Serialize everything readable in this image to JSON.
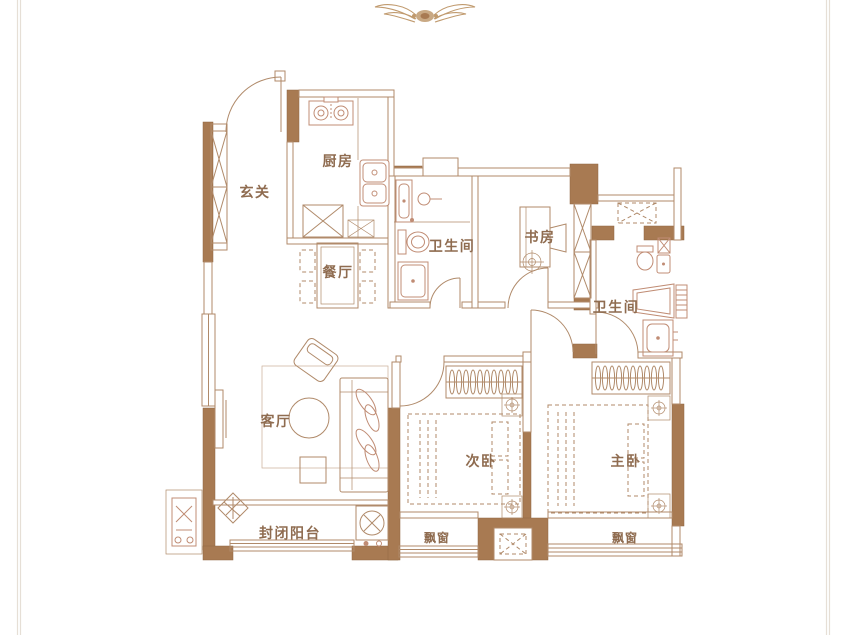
{
  "title": "apartment-floor-plan",
  "ornament": "winged-emblem",
  "rooms": {
    "entry": {
      "label": "玄关"
    },
    "kitchen": {
      "label": "厨房"
    },
    "bath1": {
      "label": "卫生间"
    },
    "study": {
      "label": "书房"
    },
    "dining": {
      "label": "餐厅"
    },
    "living": {
      "label": "客厅"
    },
    "bedroom2": {
      "label": "次卧"
    },
    "master": {
      "label": "主卧"
    },
    "bath2": {
      "label": "卫生间"
    },
    "balcony": {
      "label": "封闭阳台"
    },
    "bay_left": {
      "label": "飘窗"
    },
    "bay_right": {
      "label": "飘窗"
    }
  },
  "colors": {
    "wall": "#A87A52",
    "wallStroke": "#8F6740",
    "line": "#B08A6A",
    "fixture": "#C08C74",
    "label": "#8F6C50",
    "border": "#E6DFD6",
    "ornament": "#C09A6E"
  }
}
